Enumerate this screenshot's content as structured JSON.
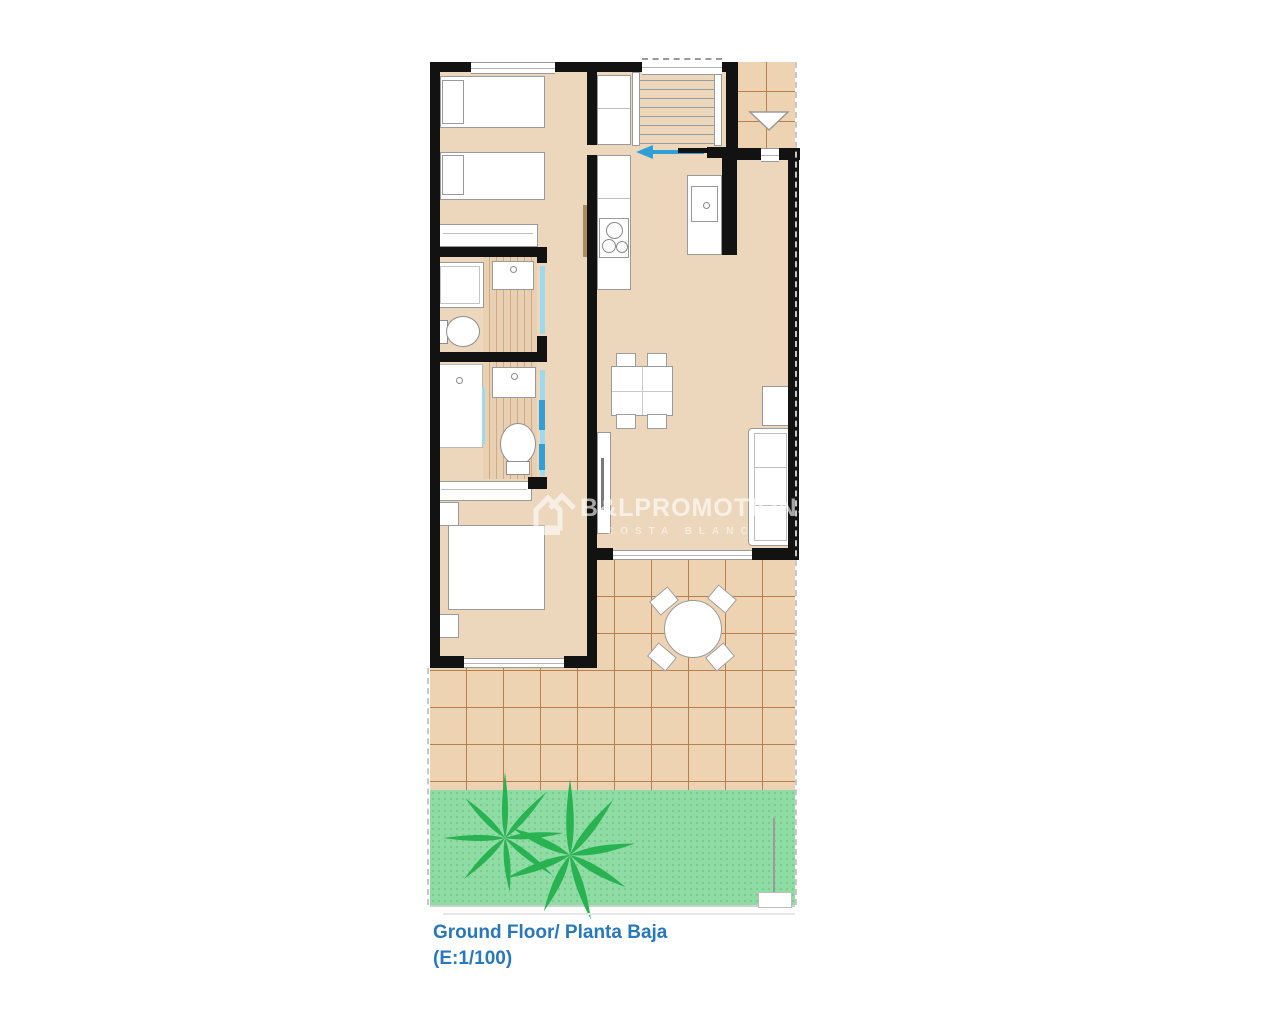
{
  "caption": {
    "line1": "Ground Floor/ Planta Baja",
    "line2": "(E:1/100)"
  },
  "watermark": {
    "brand": "B&LPROMOTIONS",
    "subtitle": "COSTA BLANCA",
    "logo": "house-icon"
  },
  "colors": {
    "wall": "#121212",
    "floor": "#ecd7bc",
    "tile": "#edd3b2",
    "tileline": "#b5804f",
    "wood": "#ead0b2",
    "woodline": "#cfab84",
    "grass": "#8fdca4",
    "grassdot": "#7acb90",
    "palm": "#29b252",
    "accent": "#2f9fd6",
    "accentlight": "#9fd9ee",
    "doorleaf": "#a98e63",
    "fixture": "#ffffff",
    "fixtureline": "#9a9a9a",
    "dash": "#c8c8c8",
    "captioncolor": "#2878bd"
  }
}
